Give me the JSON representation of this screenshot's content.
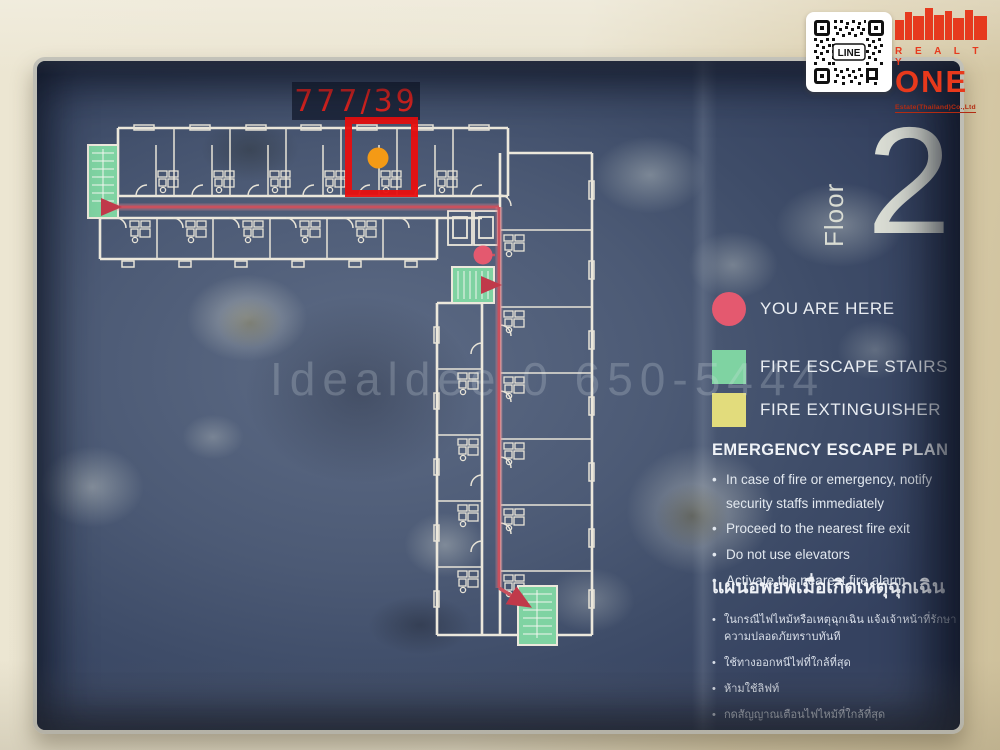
{
  "sign": {
    "floor_word": "Floor",
    "floor_number": "2",
    "highlighted_unit": "777/39",
    "watermark": "Idealdee 0   650-5444"
  },
  "legend": {
    "items": [
      {
        "shape": "circle",
        "color": "#e4596f",
        "label": "YOU ARE HERE"
      },
      {
        "shape": "square",
        "color": "#7fd3a2",
        "label": "FIRE ESCAPE STAIRS"
      },
      {
        "shape": "square",
        "color": "#e2dc7c",
        "label": "FIRE EXTINGUISHER"
      }
    ]
  },
  "emergency": {
    "title": "EMERGENCY ESCAPE PLAN",
    "bullets": [
      "In case of fire or emergency, notify security staffs immediately",
      "Proceed to the nearest fire exit",
      "Do not use elevators",
      "Activate the nearest fire alarm"
    ]
  },
  "thai": {
    "title": "แผนอพยพเมื่อเกิดเหตุฉุกเฉิน",
    "bullets": [
      "ในกรณีไฟไหม้หรือเหตุฉุกเฉิน แจ้งเจ้าหน้าที่รักษาความปลอดภัยทราบทันที",
      "ใช้ทางออกหนีไฟที่ใกล้ที่สุด",
      "ห้ามใช้ลิฟท์",
      "กดสัญญาณเตือนไฟไหม้ที่ใกล้ที่สุด"
    ]
  },
  "branding": {
    "qr_label": "LINE",
    "realty": "R E A L T Y",
    "one": "ONE",
    "subtitle": "Estate(Thailand)Co.,Ltd"
  },
  "colors": {
    "panel_navy": "#44526e",
    "plan_line": "#ece8dc",
    "route_red": "#c9515e",
    "highlight_red": "#e90f0f",
    "unit_dot_orange": "#f49a15",
    "here_pink": "#e4596f",
    "stairs_green": "#7fd3a2",
    "extinguisher_yellow": "#e2dc7c",
    "wall_beige": "#eae4d0",
    "logo_red": "#e8391c"
  }
}
